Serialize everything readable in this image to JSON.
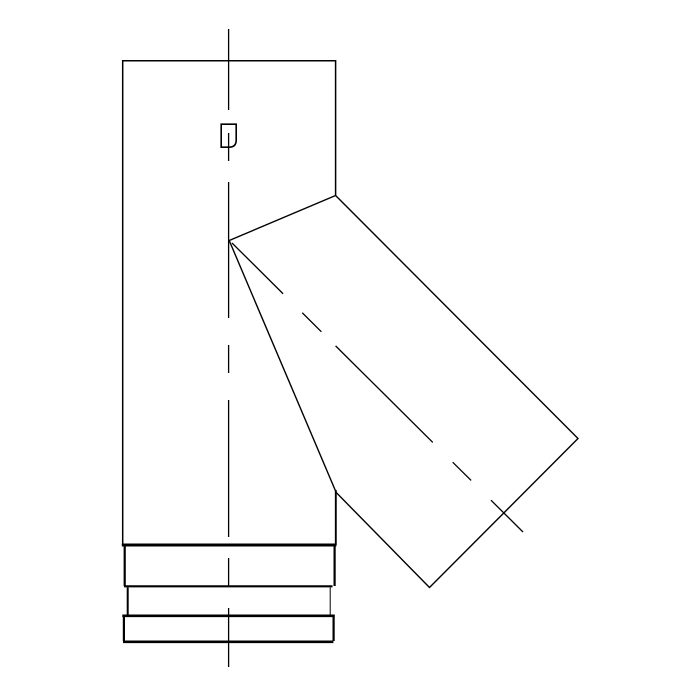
{
  "page": {
    "background": "#ffffff"
  },
  "drawing": {
    "label": "pipe-tee-45deg-branch-elevation",
    "canvas": {
      "width": 700,
      "height": 700
    },
    "colors": {
      "line": "#000000",
      "background": "#ffffff"
    },
    "elements": [
      {
        "name": "main-pipe-outline",
        "kind": "path",
        "d": "M 122.7 545 L 122.7 60.7 L 335.6 60.7 L 335.6 195.5",
        "w": 1.5
      },
      {
        "name": "main-pipe-right-edge-lower",
        "kind": "line",
        "x1": 335.8,
        "y1": 490,
        "x2": 335.8,
        "y2": 545,
        "w": 1.9
      },
      {
        "name": "branch-saddle-line",
        "kind": "line",
        "x1": 229.2,
        "y1": 240.5,
        "x2": 335.6,
        "y2": 195.5,
        "w": 1.4
      },
      {
        "name": "branch-outline",
        "kind": "path",
        "d": "M 335.6 195.5 L 578 438.5 L 429.5 587.5 L 336.2 492.5 L 229.2 240.5",
        "w": 1.4
      },
      {
        "name": "seam-clip-detail",
        "kind": "path",
        "d": "M 221.2 124.2 L 236.2 124.2 L 236.2 140 Q 236.2 147.2 229 147.2 L 221.2 147.2 Z",
        "w": 1.6
      },
      {
        "name": "collar-top-line",
        "kind": "line",
        "x1": 121.8,
        "y1": 545,
        "x2": 336.4,
        "y2": 545,
        "w": 3.0
      },
      {
        "name": "collar-band1-left-edge",
        "kind": "line",
        "x1": 124.7,
        "y1": 546.5,
        "x2": 124.7,
        "y2": 586,
        "w": 2.2
      },
      {
        "name": "collar-band1-right-edge",
        "kind": "line",
        "x1": 334.6,
        "y1": 546.5,
        "x2": 334.6,
        "y2": 586,
        "w": 2.2
      },
      {
        "name": "collar-band1-bottom-line",
        "kind": "line",
        "x1": 124.0,
        "y1": 586.3,
        "x2": 332.5,
        "y2": 586.3,
        "w": 2.2
      },
      {
        "name": "collar-band2-left-edge",
        "kind": "line",
        "x1": 127.7,
        "y1": 587.5,
        "x2": 127.7,
        "y2": 614.5,
        "w": 2.0
      },
      {
        "name": "collar-band2-right-edge",
        "kind": "line",
        "x1": 330.2,
        "y1": 587.5,
        "x2": 330.2,
        "y2": 614.5,
        "w": 1.0
      },
      {
        "name": "collar-band2-bottom-line",
        "kind": "line",
        "x1": 122.3,
        "y1": 615.8,
        "x2": 334.8,
        "y2": 615.8,
        "w": 2.6
      },
      {
        "name": "collar-band3-left-edge",
        "kind": "line",
        "x1": 123.9,
        "y1": 617,
        "x2": 123.9,
        "y2": 641,
        "w": 2.2
      },
      {
        "name": "collar-band3-right-edge",
        "kind": "line",
        "x1": 333.6,
        "y1": 617,
        "x2": 333.6,
        "y2": 641,
        "w": 2.2
      },
      {
        "name": "collar-band3-bottom-line",
        "kind": "line",
        "x1": 123.0,
        "y1": 641.8,
        "x2": 333.4,
        "y2": 641.8,
        "w": 2.6
      },
      {
        "name": "main-axis-centerline",
        "kind": "line",
        "x1": 228.6,
        "y1": 29,
        "x2": 228.6,
        "y2": 667,
        "w": 1.3,
        "dash": "81 23 28 21 136 27 28 27 137 21 29 21 59"
      },
      {
        "name": "branch-axis-centerline",
        "kind": "line",
        "x1": 232,
        "y1": 243,
        "x2": 523,
        "y2": 532,
        "w": 1.3,
        "dash": "72 27 27 20 137 28 26 28 46"
      }
    ]
  }
}
